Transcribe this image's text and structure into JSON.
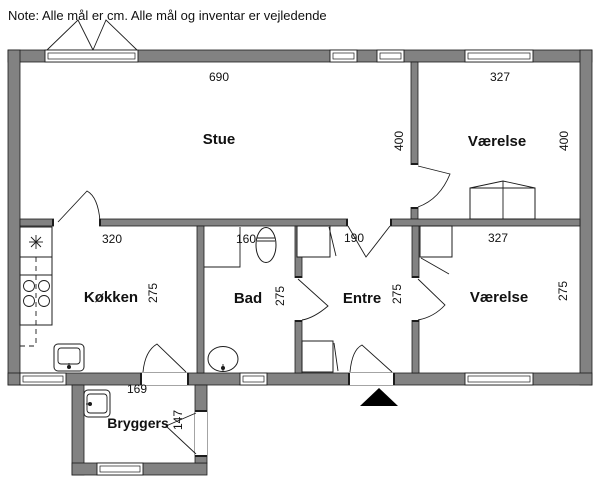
{
  "note": "Note: Alle mål er cm. Alle mål og inventar er vejledende",
  "colors": {
    "wall": "#828282",
    "line": "#1c1c1c",
    "background": "#ffffff"
  },
  "rooms": [
    {
      "id": "stue",
      "label": "Stue",
      "width_cm": "690",
      "height_cm": "400"
    },
    {
      "id": "vaerelse-top",
      "label": "Værelse",
      "width_cm": "327",
      "height_cm": "400"
    },
    {
      "id": "koekken",
      "label": "Køkken",
      "width_cm": "320",
      "height_cm": "275"
    },
    {
      "id": "bad",
      "label": "Bad",
      "width_cm": "160",
      "height_cm": "275"
    },
    {
      "id": "entre",
      "label": "Entre",
      "width_cm": "190",
      "height_cm": "275"
    },
    {
      "id": "vaerelse-bottom",
      "label": "Værelse",
      "width_cm": "327",
      "height_cm": "275"
    },
    {
      "id": "bryggers",
      "label": "Bryggers",
      "width_cm": "169",
      "height_cm": "147"
    }
  ]
}
